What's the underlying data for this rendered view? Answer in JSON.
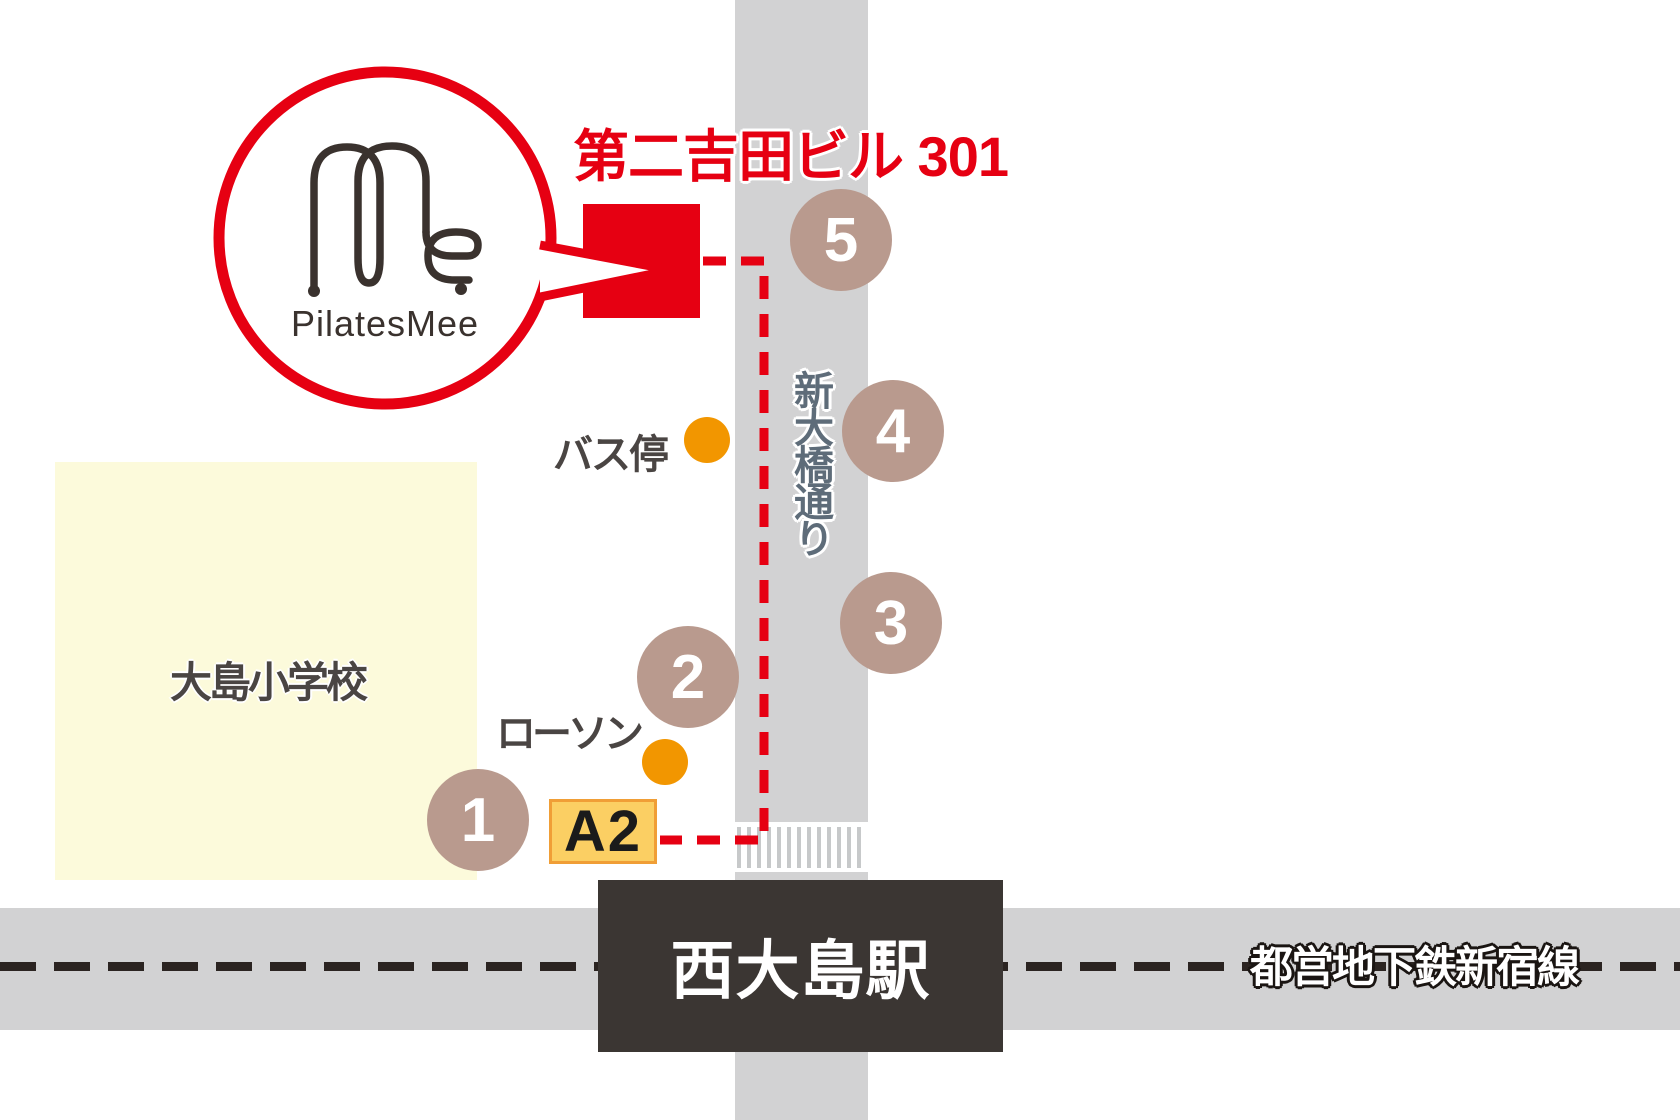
{
  "map": {
    "destination_label": "第二吉田ビル 301",
    "logo": {
      "brand": "PilatesMee"
    },
    "street_label": "新大橋通り",
    "rail_label": "都営地下鉄新宿線",
    "station_label": "西大島駅",
    "school_label": "大島小学校",
    "bus_stop_label": "バス停",
    "convenience_label": "ローソン",
    "exit_label": "A2",
    "route_points": [
      "1",
      "2",
      "3",
      "4",
      "5"
    ],
    "colors": {
      "accent_red": "#E60012",
      "route_circle_fill": "#B99A8E",
      "road_gray": "#D2D2D3",
      "station_dark": "#3B3633",
      "school_yellow": "#FCFADB",
      "landmark_orange": "#F29600",
      "exit_fill": "#FBCF63",
      "exit_border": "#F09E36",
      "street_text": "#5E6C79"
    }
  }
}
